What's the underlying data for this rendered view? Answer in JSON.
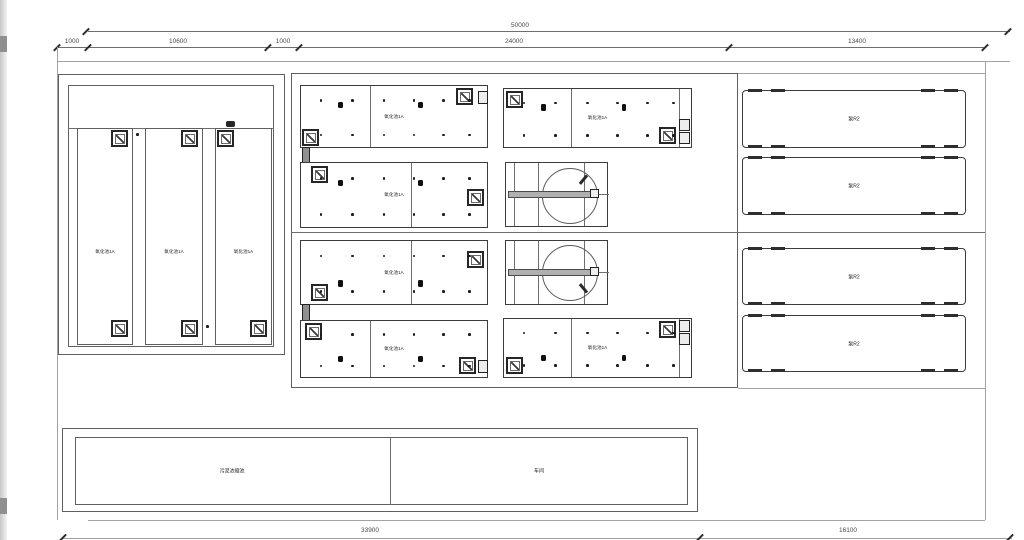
{
  "drawing": {
    "dims": {
      "total": "50000",
      "top": [
        "1000",
        "10600",
        "1000",
        "24000",
        "13400"
      ],
      "bottom": [
        "33900",
        "16100"
      ]
    },
    "left_block": {
      "tanks": [
        {
          "label": "氧化池1A"
        },
        {
          "label": "氧化池1A"
        },
        {
          "label": "氧化池1A"
        }
      ]
    },
    "middle_block": {
      "tanks": [
        {
          "label": "氧化池1A"
        },
        {
          "label": "氧化池1A"
        },
        {
          "label": "氧化池1A"
        },
        {
          "label": "氧化池1A"
        },
        {
          "label": "氧化池1A"
        },
        {
          "label": "氧化池1A"
        }
      ]
    },
    "right_block": {
      "tanks": [
        {
          "label": "泵R2"
        },
        {
          "label": "泵R2"
        },
        {
          "label": "泵R2"
        },
        {
          "label": "泵R2"
        }
      ]
    },
    "bottom_block": {
      "cells": [
        {
          "label": "污泥浓缩池"
        },
        {
          "label": "车间"
        }
      ]
    },
    "icons": {
      "hatch": "hatch-platform-icon",
      "valve": "valve-dot-icon",
      "clarifier": "clarifier-circle-icon"
    },
    "colors": {
      "line": "#6e6e6e",
      "dark": "#262626",
      "background": "#ffffff"
    }
  }
}
